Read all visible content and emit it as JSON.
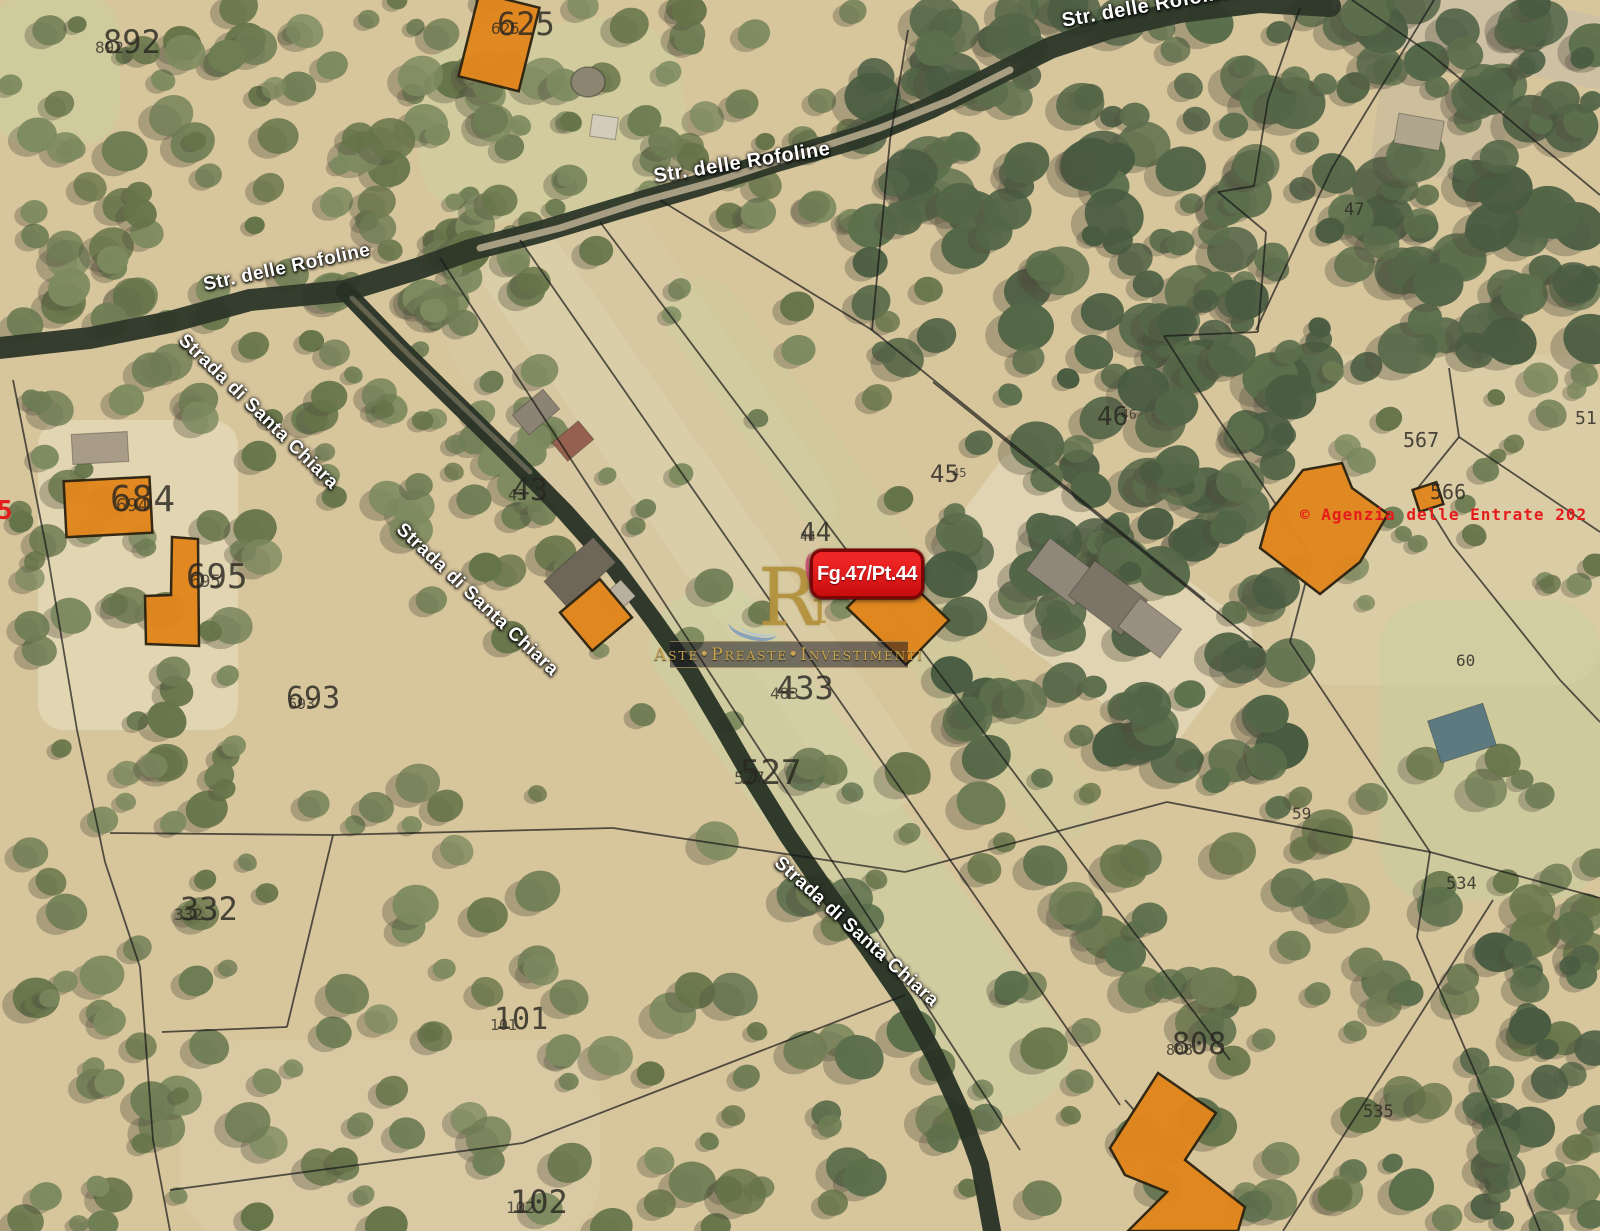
{
  "red_plot_label": {
    "text": "Fg.47/Pt.44"
  },
  "copyright": {
    "text": "© Agenzia delle Entrate 202"
  },
  "edge_red_fragment": {
    "text": "5"
  },
  "watermark": {
    "logo_main": "R",
    "logo_accent": "i",
    "band_text": "Aste•Preaste•Investimenti"
  },
  "colors": {
    "base": "#d7c59c",
    "building_fill": "#e1861d",
    "building_stroke": "#2e2410",
    "parcel_line": "#181818",
    "road_dark": "#2c3728",
    "label_red": "#e51c1c"
  },
  "road_labels": [
    {
      "text": "Str. delle Rofoline",
      "x": 287,
      "y": 268,
      "rot": -12,
      "fs": 19
    },
    {
      "text": "Str. delle Rofoline",
      "x": 742,
      "y": 163,
      "rot": -9,
      "fs": 20
    },
    {
      "text": "Str. delle Rofoline",
      "x": 1150,
      "y": 6,
      "rot": -10,
      "fs": 20
    },
    {
      "text": "Strada di Santa Chiara",
      "x": 258,
      "y": 412,
      "rot": 44,
      "fs": 19
    },
    {
      "text": "Strada di Santa Chiara",
      "x": 477,
      "y": 600,
      "rot": 43,
      "fs": 19
    },
    {
      "text": "Strada di Santa Chiara",
      "x": 856,
      "y": 932,
      "rot": 42,
      "fs": 19
    }
  ],
  "parcel_labels": [
    {
      "b": "892",
      "s": "892",
      "x": 103,
      "y": 26,
      "fs": 32,
      "sdx": -8,
      "sdy": 14
    },
    {
      "b": "625",
      "s": "625",
      "x": 497,
      "y": 8,
      "fs": 32,
      "sdx": -6,
      "sdy": 13
    },
    {
      "b": "684",
      "s": "694",
      "x": 110,
      "y": 482,
      "fs": 36,
      "sdx": 6,
      "sdy": 15
    },
    {
      "b": "695",
      "s": "695",
      "x": 186,
      "y": 560,
      "fs": 34,
      "sdx": 4,
      "sdy": 14
    },
    {
      "b": "693",
      "s": "693",
      "x": 286,
      "y": 684,
      "fs": 30,
      "sdx": 2,
      "sdy": 13
    },
    {
      "b": "43",
      "s": "43",
      "x": 512,
      "y": 476,
      "fs": 30,
      "sdx": -4,
      "sdy": 12
    },
    {
      "b": "44",
      "s": "44",
      "x": 800,
      "y": 520,
      "fs": 26,
      "sdx": 0,
      "sdy": 11
    },
    {
      "b": "45",
      "s": "45",
      "x": 930,
      "y": 462,
      "fs": 24,
      "sdx": 22,
      "sdy": 5
    },
    {
      "b": "46",
      "s": "46",
      "x": 1097,
      "y": 404,
      "fs": 26,
      "sdx": 24,
      "sdy": 5
    },
    {
      "b": "433",
      "s": "483",
      "x": 776,
      "y": 672,
      "fs": 32,
      "sdx": -6,
      "sdy": 14
    },
    {
      "b": "527",
      "s": "527",
      "x": 740,
      "y": 756,
      "fs": 34,
      "sdx": -6,
      "sdy": 15
    },
    {
      "b": "332",
      "s": "332",
      "x": 180,
      "y": 893,
      "fs": 32,
      "sdx": -6,
      "sdy": 14
    },
    {
      "b": "101",
      "s": "101",
      "x": 494,
      "y": 1005,
      "fs": 30,
      "sdx": -4,
      "sdy": 13
    },
    {
      "b": "102",
      "s": "102",
      "x": 510,
      "y": 1186,
      "fs": 32,
      "sdx": -4,
      "sdy": 14
    },
    {
      "b": "808",
      "s": "808",
      "x": 1172,
      "y": 1030,
      "fs": 30,
      "sdx": -6,
      "sdy": 13
    },
    {
      "b": "47",
      "x": 1344,
      "y": 202,
      "fs": 17
    },
    {
      "b": "51",
      "x": 1575,
      "y": 410,
      "fs": 18
    },
    {
      "b": "567",
      "x": 1403,
      "y": 430,
      "fs": 20
    },
    {
      "b": "566",
      "x": 1430,
      "y": 482,
      "fs": 20
    },
    {
      "b": "60",
      "x": 1456,
      "y": 653,
      "fs": 16
    },
    {
      "b": "59",
      "x": 1292,
      "y": 806,
      "fs": 16
    },
    {
      "b": "534",
      "x": 1446,
      "y": 876,
      "fs": 17
    },
    {
      "b": "535",
      "x": 1363,
      "y": 1104,
      "fs": 17
    }
  ],
  "roads": [
    {
      "name": "strada-delle-rofoline",
      "w": 22,
      "color": "#2c3728",
      "op": 0.95,
      "pts": [
        [
          0,
          348
        ],
        [
          90,
          338
        ],
        [
          170,
          322
        ],
        [
          250,
          300
        ],
        [
          345,
          291
        ],
        [
          420,
          268
        ],
        [
          470,
          250
        ],
        [
          540,
          232
        ],
        [
          620,
          208
        ],
        [
          700,
          185
        ],
        [
          780,
          160
        ],
        [
          860,
          137
        ],
        [
          930,
          108
        ],
        [
          990,
          78
        ],
        [
          1050,
          48
        ],
        [
          1110,
          28
        ],
        [
          1180,
          12
        ],
        [
          1260,
          2
        ],
        [
          1330,
          6
        ]
      ]
    },
    {
      "name": "strada-di-santa-chiara",
      "w": 18,
      "color": "#273125",
      "op": 0.95,
      "pts": [
        [
          345,
          291
        ],
        [
          400,
          348
        ],
        [
          455,
          402
        ],
        [
          510,
          456
        ],
        [
          565,
          512
        ],
        [
          615,
          568
        ],
        [
          655,
          622
        ],
        [
          690,
          672
        ],
        [
          722,
          726
        ],
        [
          752,
          778
        ],
        [
          788,
          836
        ],
        [
          828,
          894
        ],
        [
          868,
          948
        ],
        [
          905,
          1002
        ],
        [
          935,
          1056
        ],
        [
          960,
          1110
        ],
        [
          980,
          1165
        ],
        [
          992,
          1231
        ]
      ]
    }
  ],
  "road_overlays": [
    {
      "w": 7,
      "color": "#b3a78c",
      "op": 0.9,
      "pts": [
        [
          480,
          248
        ],
        [
          560,
          228
        ],
        [
          640,
          202
        ],
        [
          720,
          180
        ],
        [
          800,
          154
        ],
        [
          880,
          128
        ],
        [
          950,
          100
        ],
        [
          1010,
          70
        ]
      ]
    },
    {
      "w": 5,
      "color": "#8e8670",
      "op": 0.55,
      "pts": [
        [
          352,
          298
        ],
        [
          410,
          356
        ],
        [
          470,
          414
        ],
        [
          530,
          472
        ]
      ]
    }
  ],
  "parcel_lines": [
    [
      440,
      258,
      1020,
      1150
    ],
    [
      520,
      240,
      1120,
      1105
    ],
    [
      600,
      222,
      1230,
      1060
    ],
    [
      660,
      200,
      872,
      330
    ],
    [
      872,
      330,
      1205,
      600
    ],
    [
      933,
      382,
      1262,
      648
    ],
    [
      908,
      30,
      890,
      140
    ],
    [
      890,
      140,
      872,
      330
    ],
    [
      1300,
      8,
      1268,
      100
    ],
    [
      1268,
      100,
      1254,
      186
    ],
    [
      1254,
      186,
      1218,
      192
    ],
    [
      1218,
      192,
      1266,
      232
    ],
    [
      1266,
      232,
      1258,
      332
    ],
    [
      1258,
      332,
      1164,
      336
    ],
    [
      1164,
      336,
      1192,
      380
    ],
    [
      1434,
      0,
      1332,
      168
    ],
    [
      1332,
      168,
      1256,
      330
    ],
    [
      1352,
      0,
      1428,
      52
    ],
    [
      1428,
      52,
      1600,
      195
    ],
    [
      1192,
      380,
      1312,
      558
    ],
    [
      1312,
      558,
      1290,
      642
    ],
    [
      1449,
      368,
      1459,
      437
    ],
    [
      1459,
      437,
      1600,
      532
    ],
    [
      1459,
      437,
      1417,
      489
    ],
    [
      1417,
      489,
      1452,
      545
    ],
    [
      1452,
      545,
      1560,
      680
    ],
    [
      1560,
      680,
      1600,
      722
    ],
    [
      1290,
      642,
      1430,
      852
    ],
    [
      905,
      872,
      1167,
      802
    ],
    [
      1167,
      802,
      1430,
      852
    ],
    [
      1430,
      852,
      1417,
      937
    ],
    [
      1430,
      852,
      1600,
      898
    ],
    [
      1493,
      900,
      1283,
      1231
    ],
    [
      1417,
      937,
      1500,
      1130
    ],
    [
      1500,
      1130,
      1540,
      1231
    ],
    [
      1125,
      1100,
      1142,
      1119
    ],
    [
      13,
      380,
      48,
      557
    ],
    [
      48,
      557,
      77,
      730
    ],
    [
      77,
      730,
      105,
      862
    ],
    [
      105,
      862,
      140,
      967
    ],
    [
      140,
      967,
      153,
      1140
    ],
    [
      153,
      1140,
      170,
      1231
    ],
    [
      110,
      833,
      333,
      835
    ],
    [
      333,
      835,
      613,
      828
    ],
    [
      613,
      828,
      905,
      872
    ],
    [
      333,
      835,
      287,
      1027
    ],
    [
      287,
      1027,
      162,
      1032
    ],
    [
      170,
      1190,
      523,
      1143
    ],
    [
      523,
      1143,
      905,
      995
    ]
  ],
  "buildings": [
    {
      "type": "rect",
      "cx": 499,
      "cy": 42,
      "w": 62,
      "h": 86,
      "rot": 14
    },
    {
      "type": "rect",
      "cx": 108,
      "cy": 507,
      "w": 86,
      "h": 56,
      "rot": -3
    },
    {
      "type": "poly",
      "pts": [
        [
          172,
          537
        ],
        [
          198,
          539
        ],
        [
          199,
          646
        ],
        [
          146,
          644
        ],
        [
          145,
          596
        ],
        [
          171,
          595
        ]
      ]
    },
    {
      "type": "rect",
      "cx": 596,
      "cy": 615,
      "w": 52,
      "h": 50,
      "rot": -40
    },
    {
      "type": "rect",
      "cx": 898,
      "cy": 614,
      "w": 82,
      "h": 62,
      "rot": 44
    },
    {
      "type": "poly",
      "pts": [
        [
          1270,
          512
        ],
        [
          1303,
          470
        ],
        [
          1342,
          463
        ],
        [
          1352,
          488
        ],
        [
          1388,
          514
        ],
        [
          1360,
          562
        ],
        [
          1320,
          594
        ],
        [
          1260,
          548
        ]
      ]
    },
    {
      "type": "rect",
      "cx": 1428,
      "cy": 497,
      "w": 25,
      "h": 23,
      "rot": -18
    },
    {
      "type": "poly",
      "pts": [
        [
          1158,
          1073
        ],
        [
          1216,
          1113
        ],
        [
          1185,
          1160
        ],
        [
          1245,
          1207
        ],
        [
          1238,
          1231
        ],
        [
          1128,
          1231
        ],
        [
          1167,
          1192
        ],
        [
          1125,
          1175
        ],
        [
          1110,
          1148
        ]
      ]
    }
  ],
  "minor_buildings": [
    {
      "shape": "rect",
      "cx": 536,
      "cy": 412,
      "w": 40,
      "h": 26,
      "rot": -40,
      "fill": "#8d8375"
    },
    {
      "shape": "rect",
      "cx": 573,
      "cy": 441,
      "w": 34,
      "h": 24,
      "rot": -40,
      "fill": "#96604f"
    },
    {
      "shape": "rect",
      "cx": 580,
      "cy": 572,
      "w": 66,
      "h": 34,
      "rot": -42,
      "fill": "#6e6759"
    },
    {
      "shape": "rect",
      "cx": 617,
      "cy": 598,
      "w": 30,
      "h": 22,
      "rot": -42,
      "fill": "#b9b0a0"
    },
    {
      "shape": "rect",
      "cx": 1062,
      "cy": 572,
      "w": 60,
      "h": 40,
      "rot": 37,
      "fill": "#8f8779"
    },
    {
      "shape": "rect",
      "cx": 1108,
      "cy": 598,
      "w": 66,
      "h": 44,
      "rot": 37,
      "fill": "#7c7466"
    },
    {
      "shape": "rect",
      "cx": 1150,
      "cy": 628,
      "w": 52,
      "h": 36,
      "rot": 37,
      "fill": "#999082"
    },
    {
      "shape": "rect",
      "cx": 604,
      "cy": 127,
      "w": 26,
      "h": 22,
      "rot": 8,
      "fill": "#d3ccba"
    },
    {
      "shape": "ellipse",
      "cx": 588,
      "cy": 82,
      "w": 34,
      "h": 30,
      "rot": 0,
      "fill": "#8b8572"
    },
    {
      "shape": "rect",
      "cx": 1462,
      "cy": 733,
      "w": 58,
      "h": 44,
      "rot": -18,
      "fill": "#5c7a80"
    },
    {
      "shape": "rect",
      "cx": 1419,
      "cy": 132,
      "w": 46,
      "h": 30,
      "rot": 10,
      "fill": "#b0a68e"
    },
    {
      "shape": "rect",
      "cx": 100,
      "cy": 448,
      "w": 56,
      "h": 30,
      "rot": -3,
      "fill": "#a89c88"
    }
  ],
  "terrain_patches": [
    {
      "cx": 55,
      "cy": 70,
      "w": 130,
      "h": 150,
      "rot": 0,
      "rx": 40,
      "fill": "#c9cf9f",
      "op": 0.55
    },
    {
      "cx": 550,
      "cy": 120,
      "w": 270,
      "h": 190,
      "rot": -8,
      "rx": 70,
      "fill": "#ccd19e",
      "op": 0.5
    },
    {
      "cx": 640,
      "cy": 420,
      "w": 420,
      "h": 240,
      "rot": 55,
      "rx": 60,
      "fill": "#d7cda8",
      "op": 0.45
    },
    {
      "cx": 700,
      "cy": 520,
      "w": 700,
      "h": 85,
      "rot": 55,
      "rx": 40,
      "fill": "#dbd4ad",
      "op": 0.5
    },
    {
      "cx": 880,
      "cy": 560,
      "w": 680,
      "h": 75,
      "rot": 54,
      "rx": 40,
      "fill": "#c9cf9e",
      "op": 0.45
    },
    {
      "cx": 860,
      "cy": 850,
      "w": 620,
      "h": 120,
      "rot": 54,
      "rx": 50,
      "fill": "#cbd2a3",
      "op": 0.5
    },
    {
      "cx": 1445,
      "cy": 520,
      "w": 310,
      "h": 330,
      "rot": 0,
      "rx": 40,
      "fill": "#dccfa9",
      "op": 0.7
    },
    {
      "cx": 1490,
      "cy": 750,
      "w": 220,
      "h": 300,
      "rot": 0,
      "rx": 50,
      "fill": "#c8d09f",
      "op": 0.5
    },
    {
      "cx": 1090,
      "cy": 600,
      "w": 310,
      "h": 150,
      "rot": 37,
      "rx": 16,
      "fill": "#e2d6b6",
      "op": 0.85
    },
    {
      "cx": 138,
      "cy": 575,
      "w": 200,
      "h": 310,
      "rot": 0,
      "rx": 26,
      "fill": "#e5d8b6",
      "op": 0.8
    },
    {
      "cx": 390,
      "cy": 1140,
      "w": 420,
      "h": 200,
      "rot": 0,
      "rx": 60,
      "fill": "#dcd0ac",
      "op": 0.5
    },
    {
      "cx": 1490,
      "cy": 30,
      "w": 270,
      "h": 72,
      "rot": 12,
      "rx": 10,
      "fill": "#cdc0a4",
      "op": 0.9
    },
    {
      "cx": 1440,
      "cy": 130,
      "w": 130,
      "h": 95,
      "rot": 8,
      "rx": 14,
      "fill": "#cbbc9c",
      "op": 0.8
    }
  ],
  "tree_regions": [
    {
      "x": 0,
      "y": 0,
      "w": 560,
      "h": 330,
      "count": 115,
      "rmin": 9,
      "rmax": 24,
      "seed": 1,
      "palette": [
        "#7d8a5f",
        "#6f7d54",
        "#667449"
      ]
    },
    {
      "x": 560,
      "y": 0,
      "w": 300,
      "h": 235,
      "count": 38,
      "rmin": 9,
      "rmax": 20,
      "seed": 2,
      "palette": [
        "#7d8a5f",
        "#6f7d54",
        "#667449"
      ]
    },
    {
      "x": 860,
      "y": 0,
      "w": 740,
      "h": 370,
      "count": 210,
      "rmin": 11,
      "rmax": 30,
      "seed": 3,
      "palette": [
        "#5c6f4c",
        "#536647",
        "#495c41"
      ]
    },
    {
      "x": 950,
      "y": 350,
      "w": 345,
      "h": 420,
      "count": 115,
      "rmin": 11,
      "rmax": 28,
      "seed": 4,
      "palette": [
        "#5c6f4c",
        "#536647",
        "#495c41"
      ]
    },
    {
      "x": 0,
      "y": 330,
      "w": 235,
      "h": 470,
      "count": 45,
      "rmin": 9,
      "rmax": 22,
      "seed": 5,
      "palette": [
        "#7d8a5f",
        "#6f7d54",
        "#667449"
      ]
    },
    {
      "x": 230,
      "y": 330,
      "w": 330,
      "h": 250,
      "count": 42,
      "rmin": 9,
      "rmax": 22,
      "seed": 6,
      "palette": [
        "#7d8a5f",
        "#6f7d54",
        "#667449"
      ]
    },
    {
      "x": 0,
      "y": 780,
      "w": 730,
      "h": 450,
      "count": 95,
      "rmin": 9,
      "rmax": 24,
      "seed": 7,
      "palette": [
        "#7d8a5f",
        "#6f7d54",
        "#667449"
      ]
    },
    {
      "x": 720,
      "y": 760,
      "w": 880,
      "h": 470,
      "count": 135,
      "rmin": 10,
      "rmax": 26,
      "seed": 8,
      "palette": [
        "#6f7d54",
        "#5c6f4c",
        "#667449"
      ]
    },
    {
      "x": 430,
      "y": 250,
      "w": 520,
      "h": 480,
      "count": 32,
      "rmin": 8,
      "rmax": 20,
      "seed": 9,
      "palette": [
        "#7d8a5f",
        "#6f7d54",
        "#667449"
      ]
    },
    {
      "x": 1290,
      "y": 360,
      "w": 310,
      "h": 250,
      "count": 24,
      "rmin": 8,
      "rmax": 18,
      "seed": 10,
      "palette": [
        "#7d8a5f",
        "#6f7d54",
        "#667449"
      ]
    },
    {
      "x": 1460,
      "y": 940,
      "w": 140,
      "h": 291,
      "count": 30,
      "rmin": 10,
      "rmax": 24,
      "seed": 12,
      "palette": [
        "#5c6f4c",
        "#536647",
        "#495c41"
      ]
    }
  ]
}
